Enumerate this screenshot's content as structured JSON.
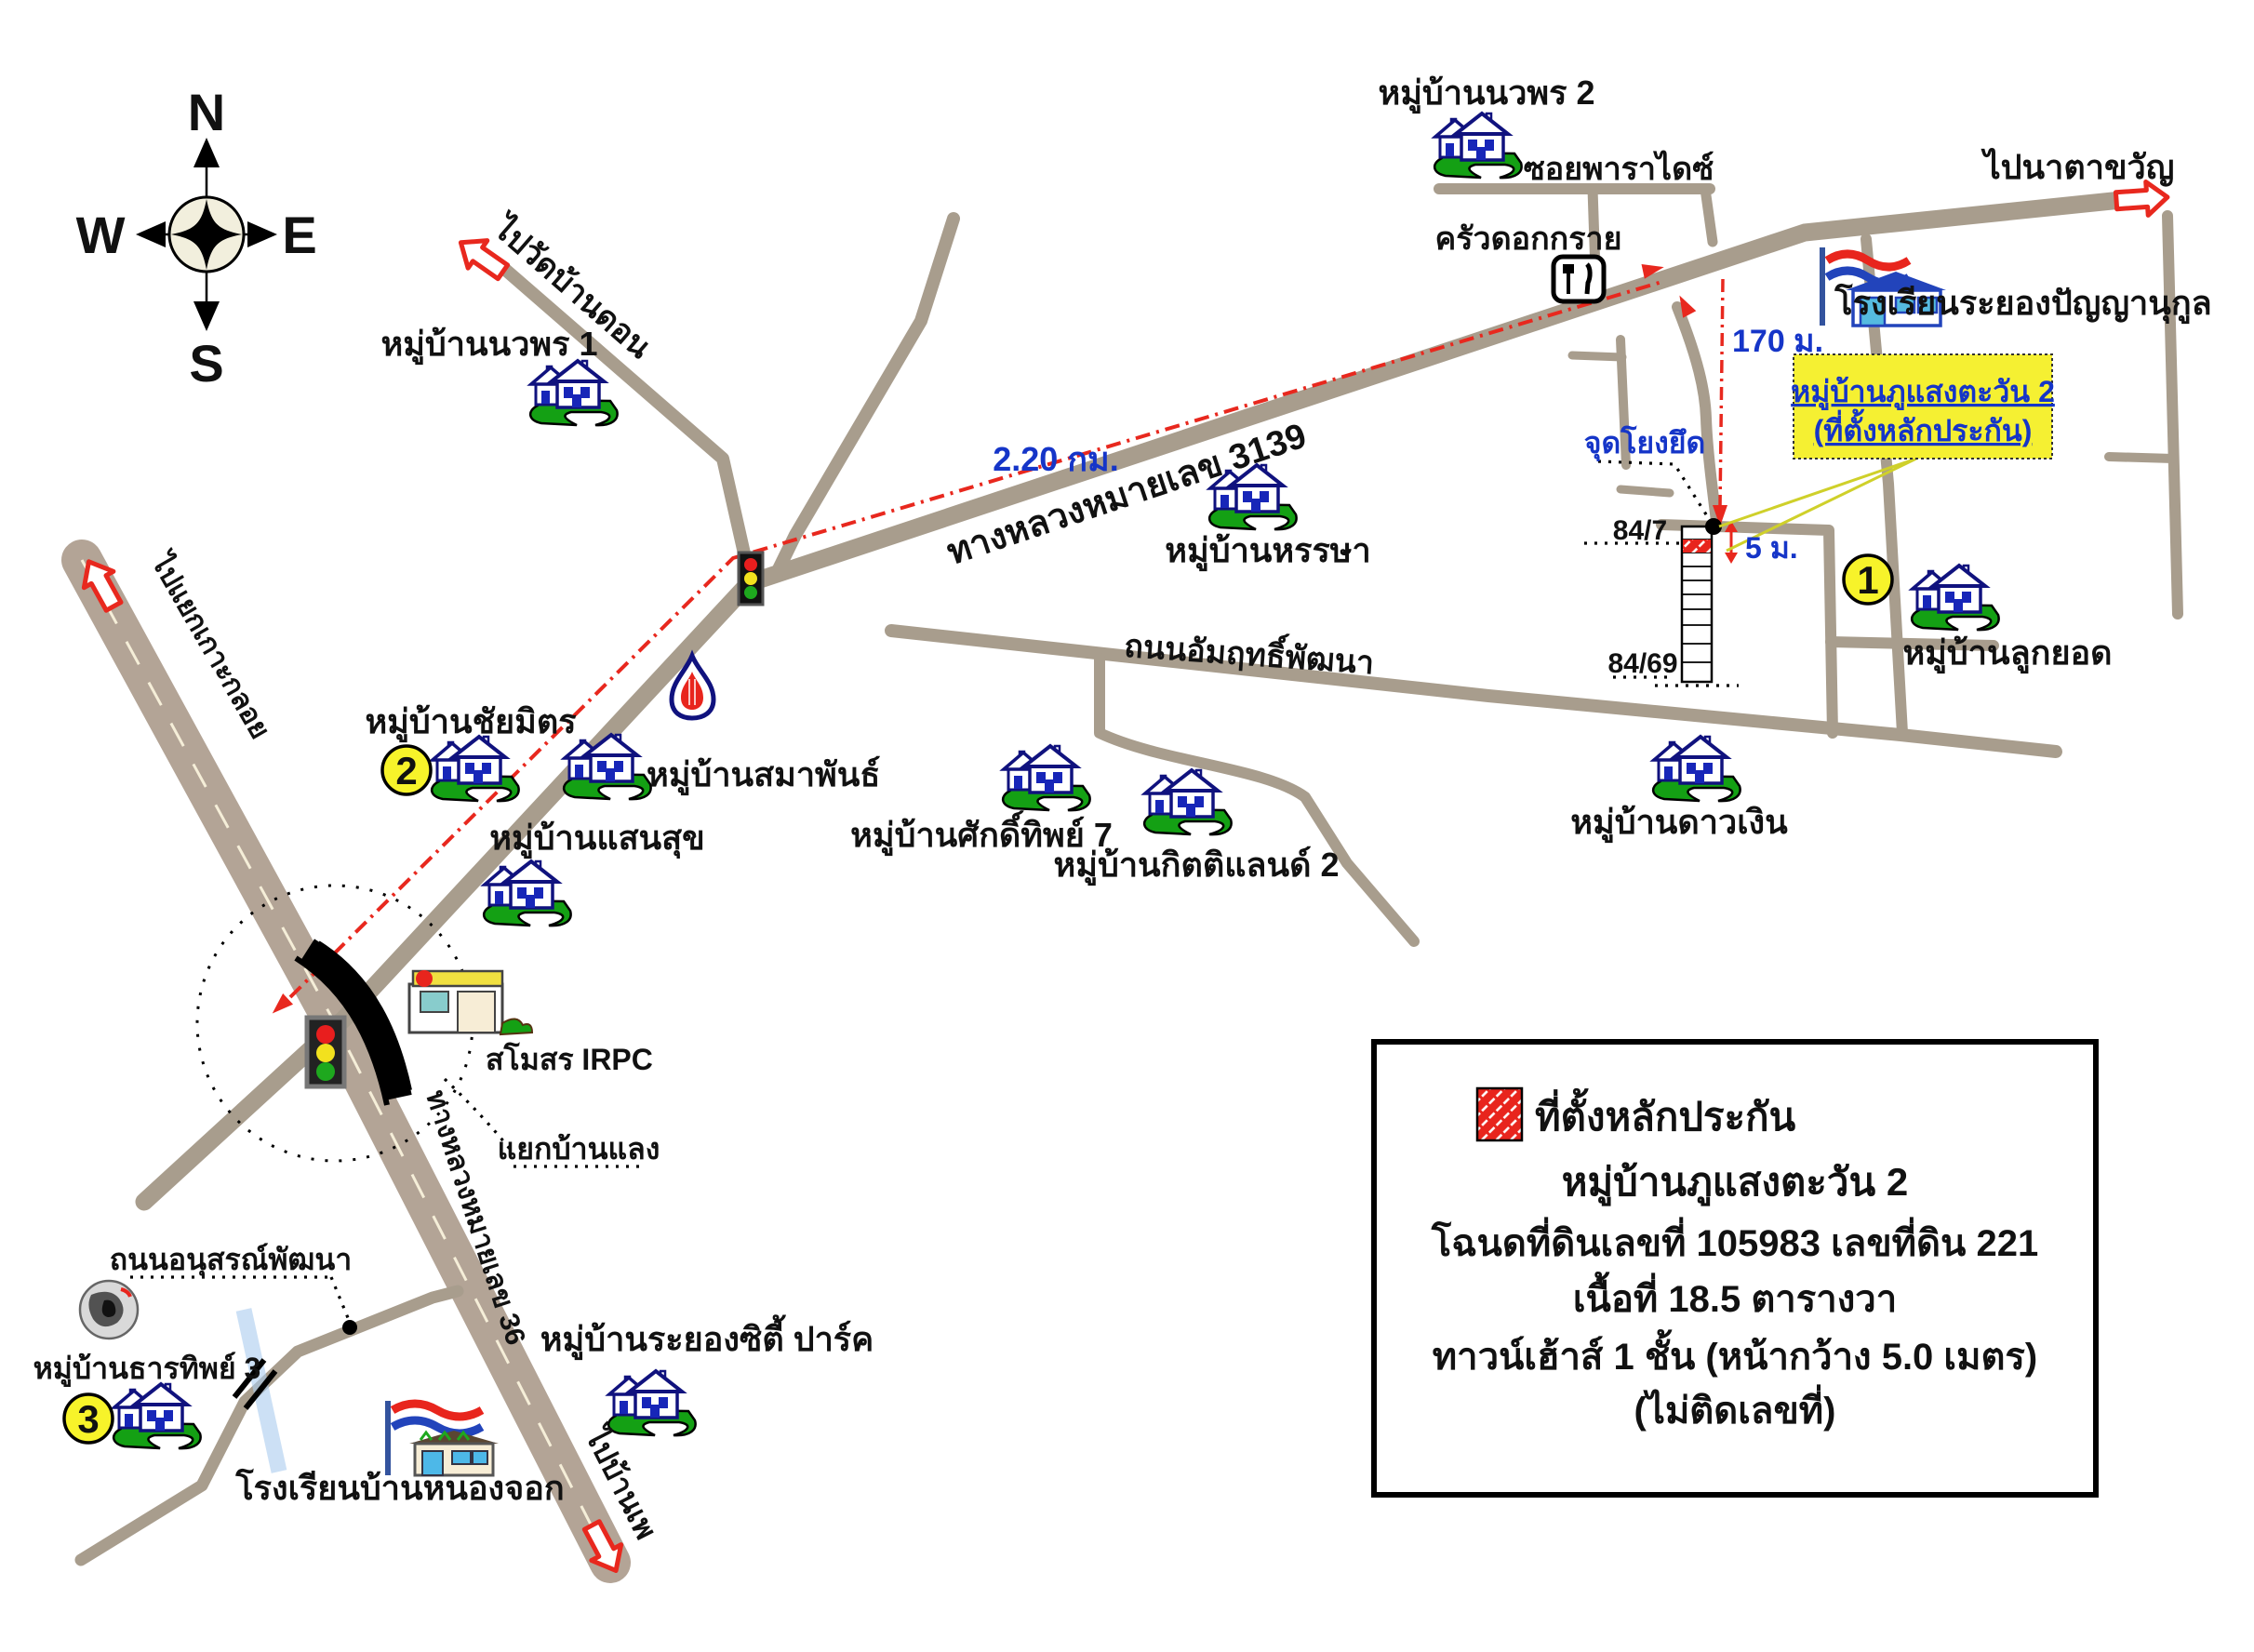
{
  "compass": {
    "north": "N",
    "east": "E",
    "south": "S",
    "west": "W"
  },
  "destinations": {
    "wat_ban_don": "ไปวัดบ้านดอน",
    "kao_kloi": "ไปแยกเกาะกลอย",
    "na_ta_khwan": "ไปนาตาขวัญ",
    "ban_phe": "ไปบ้านเพ"
  },
  "road_labels": {
    "hwy3139": "ทางหลวงหมายเลข 3139",
    "hwy36": "ทางหลวงหมายเลข 36",
    "soi_paradise": "ซอยพาราไดซ์",
    "amrit_phatthana": "ถนนอัมฤทธิ์พัฒนา",
    "anusorn_phatthana": "ถนนอนุสรณ์พัฒนา"
  },
  "villages": {
    "nawaporn2": "หมู่บ้านนวพร 2",
    "nawaporn1": "หมู่บ้านนวพร 1",
    "hansa": "หมู่บ้านหรรษา",
    "chaimit": "หมู่บ้านชัยมิตร",
    "samaphan": "หมู่บ้านสมาพันธ์",
    "saensuk": "หมู่บ้านแสนสุข",
    "sakthip7": "หมู่บ้านศักดิ์ทิพย์ 7",
    "kittiland2": "หมู่บ้านกิตติแลนด์ 2",
    "daongoen": "หมู่บ้านดาวเงิน",
    "lukyod": "หมู่บ้านลูกยอด",
    "thanthip3": "หมู่บ้านธารทิพย์ 3",
    "rayong_city_park": "หมู่บ้านระยองซิตี้ ปาร์ค"
  },
  "places": {
    "krua_dok_krai": "ครัวดอกกราย",
    "school_panyanukul": "โรงเรียนระยองปัญญานุกูล",
    "school_nongchok": "โรงเรียนบ้านหนองจอก",
    "irpc_club": "สโมสร IRPC",
    "yaek_ban_laeng": "แยกบ้านแลง"
  },
  "measurements": {
    "highway_distance": "2.20 กม.",
    "branch_distance": "170 ม.",
    "frontage_distance": "5 ม."
  },
  "property": {
    "anchor_point": "จุดโยงยึด",
    "house_no_top": "84/7",
    "house_no_bottom": "84/69"
  },
  "badges": {
    "one": "1",
    "two": "2",
    "three": "3"
  },
  "callout": {
    "line1": "หมู่บ้านภูแสงตะวัน 2",
    "line2": "(ที่ตั้งหลักประกัน)"
  },
  "legend": {
    "title": "ที่ตั้งหลักประกัน",
    "line2": "หมู่บ้านภูแสงตะวัน 2",
    "line3": "โฉนดที่ดินเลขที่ 105983 เลขที่ดิน 221",
    "line4": "เนื้อที่ 18.5 ตารางวา",
    "line5": "ทาวน์เฮ้าส์ 1 ชั้น (หน้ากว้าง 5.0 เมตร)",
    "line6": "(ไม่ติดเลขที่)"
  },
  "colors": {
    "road": "#a89d8d",
    "highway": "#b3a496",
    "route_red": "#e8281e",
    "highlight_yellow": "#f5f032",
    "legend_hatch_red": "#e8251d",
    "measure_blue": "#1535c8"
  }
}
